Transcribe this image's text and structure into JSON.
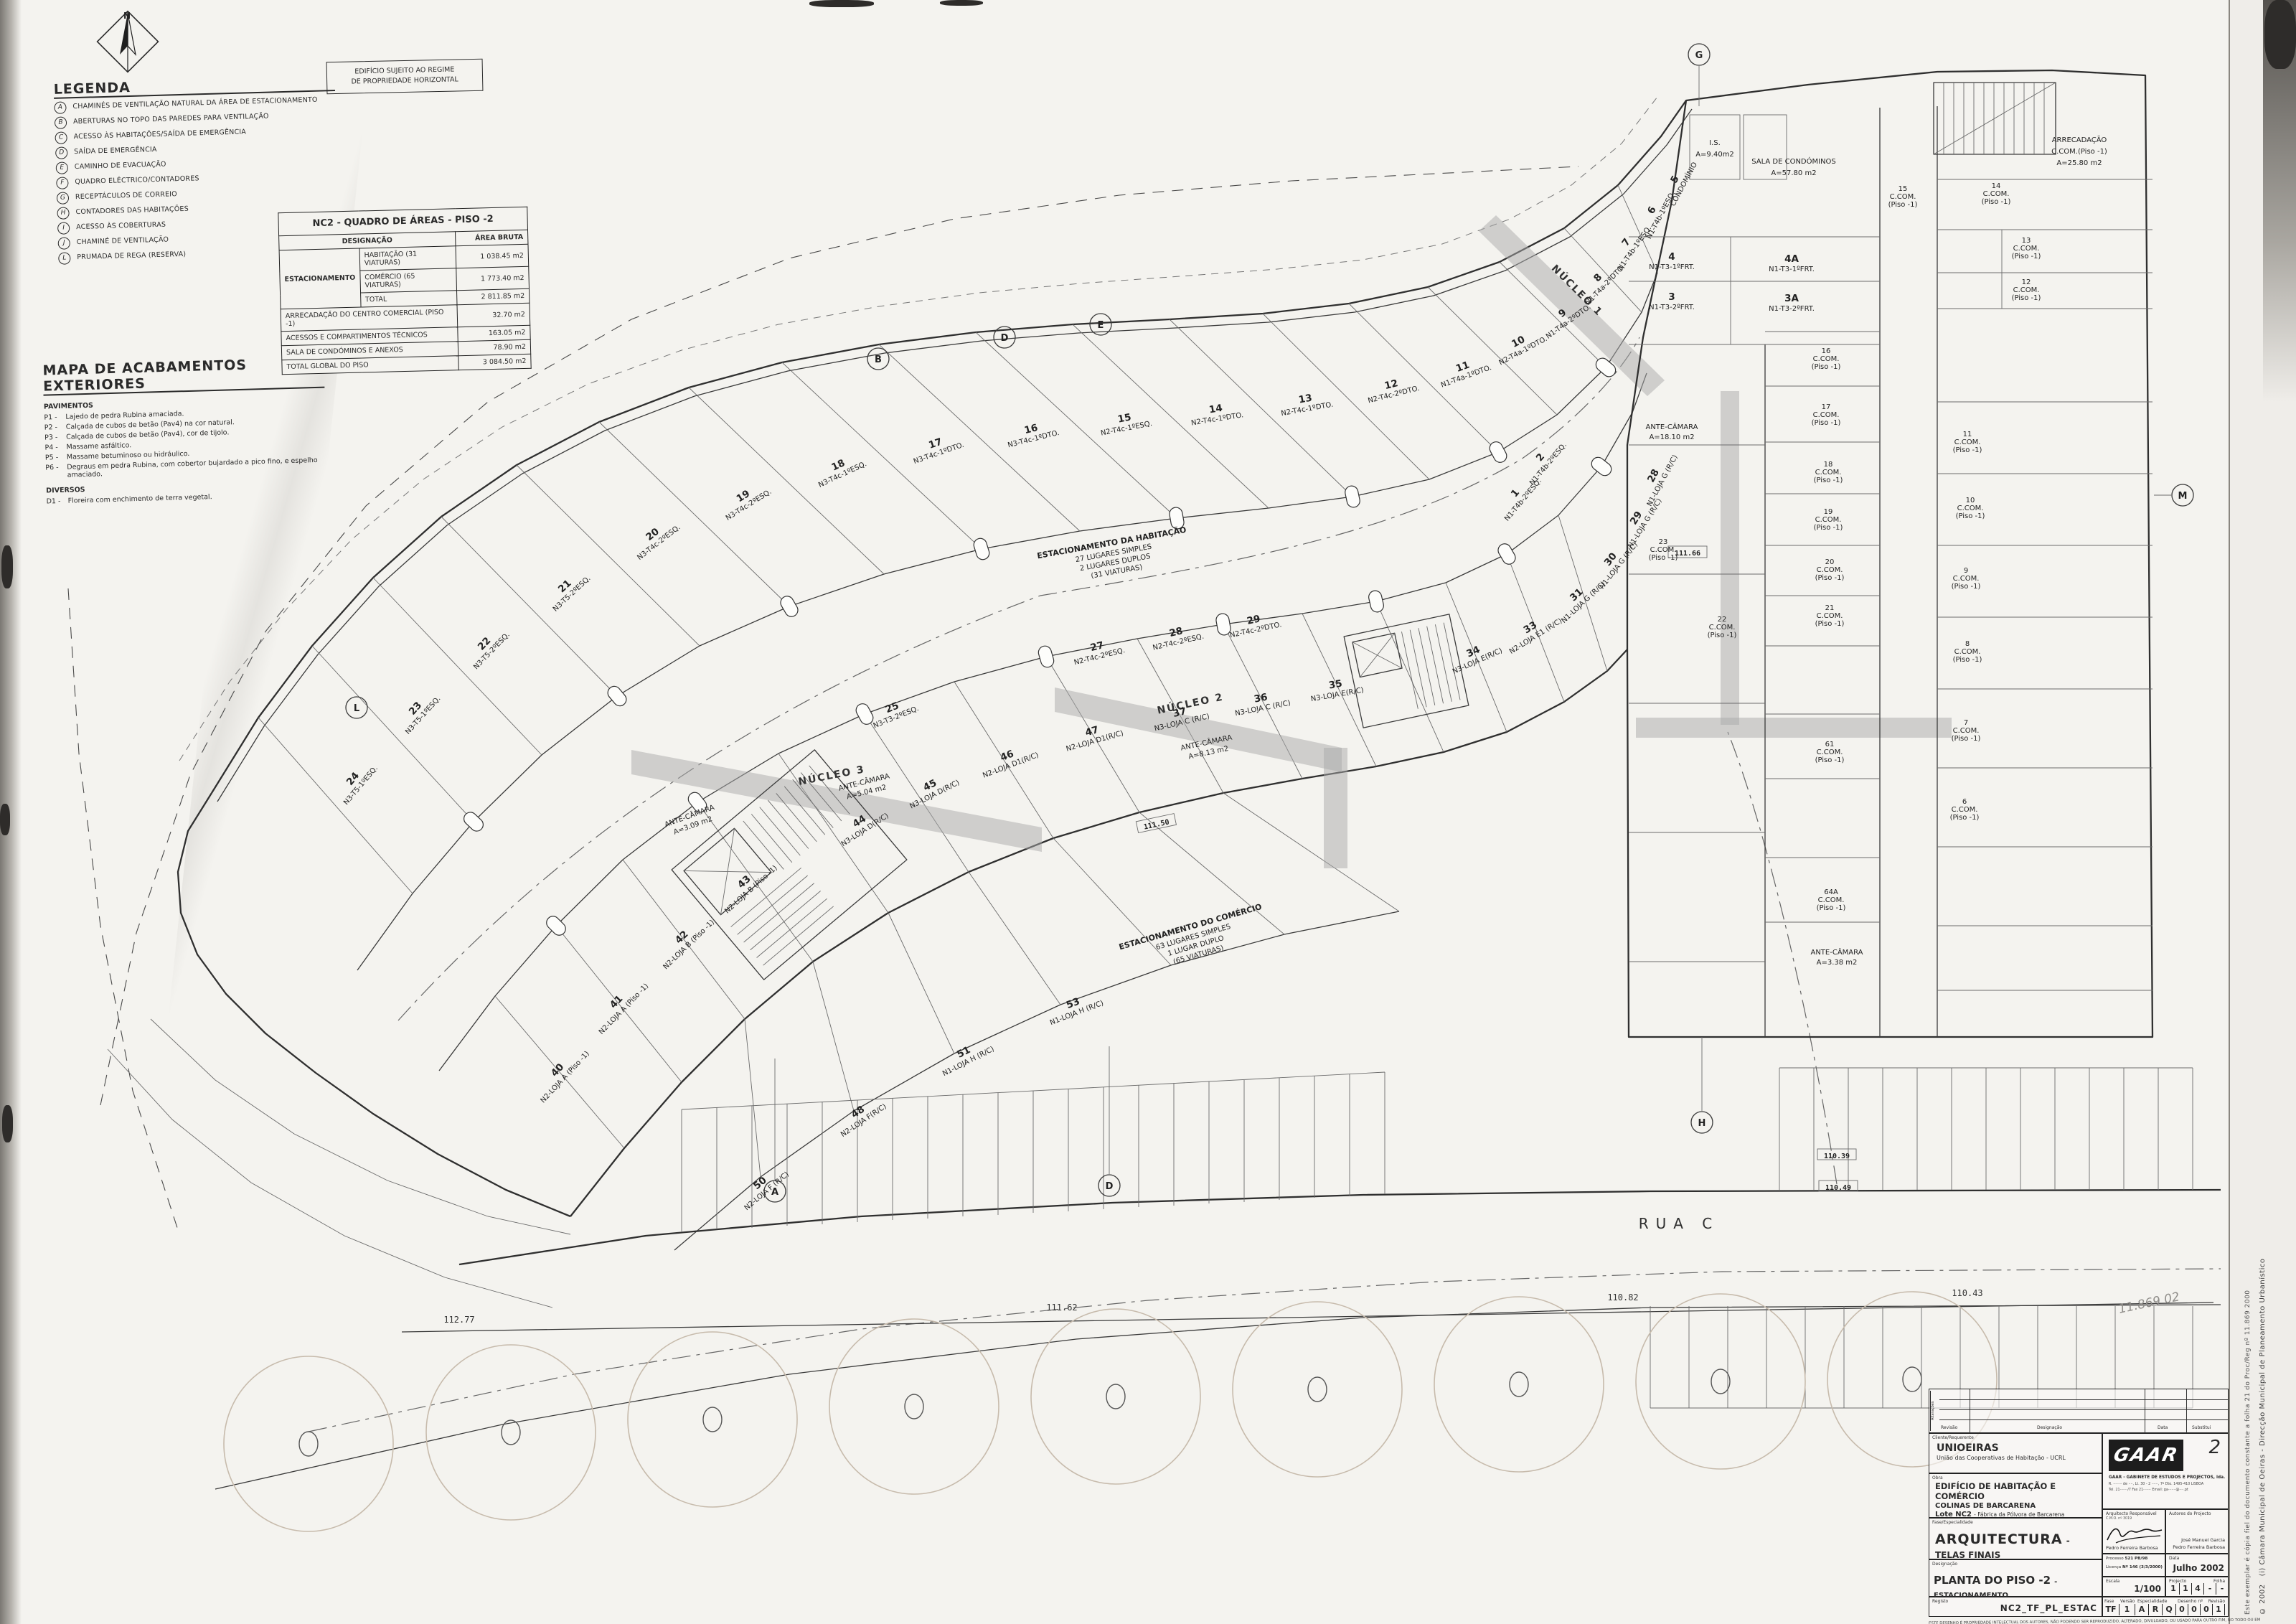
{
  "notice": {
    "line1": "EDIFÍCIO SUJEITO AO REGIME",
    "line2": "DE PROPRIEDADE HORIZONTAL"
  },
  "legend": {
    "title": "LEGENDA",
    "items": [
      {
        "k": "A",
        "t": "CHAMINÉS DE VENTILAÇÃO NATURAL DA ÁREA DE ESTACIONAMENTO"
      },
      {
        "k": "B",
        "t": "ABERTURAS NO TOPO DAS PAREDES PARA VENTILAÇÃO"
      },
      {
        "k": "C",
        "t": "ACESSO ÀS HABITAÇÕES/SAÍDA DE EMERGÊNCIA"
      },
      {
        "k": "D",
        "t": "SAÍDA DE EMERGÊNCIA"
      },
      {
        "k": "E",
        "t": "CAMINHO DE EVACUAÇÃO"
      },
      {
        "k": "F",
        "t": "QUADRO ELÉCTRICO/CONTADORES"
      },
      {
        "k": "G",
        "t": "RECEPTÁCULOS DE CORREIO"
      },
      {
        "k": "H",
        "t": "CONTADORES DAS HABITAÇÕES"
      },
      {
        "k": "I",
        "t": "ACESSO ÀS COBERTURAS"
      },
      {
        "k": "J",
        "t": "CHAMINÉ DE VENTILAÇÃO"
      },
      {
        "k": "L",
        "t": "PRUMADA DE REGA (RESERVA)"
      }
    ]
  },
  "finishes": {
    "title": "MAPA DE ACABAMENTOS EXTERIORES",
    "group1": "PAVIMENTOS",
    "items": [
      {
        "k": "P1 -",
        "t": "Lajedo de pedra Rubina amaciada."
      },
      {
        "k": "P2 -",
        "t": "Calçada de cubos de betão (Pav4) na cor natural."
      },
      {
        "k": "P3 -",
        "t": "Calçada de cubos de betão (Pav4), cor de tijolo."
      },
      {
        "k": "P4 -",
        "t": "Massame asfáltico."
      },
      {
        "k": "P5 -",
        "t": "Massame betuminoso ou hidráulico."
      },
      {
        "k": "P6 -",
        "t": "Degraus em pedra Rubina, com cobertor bujardado a pico fino, e espelho amaciado."
      }
    ],
    "group2": "DIVERSOS",
    "d1k": "D1 -",
    "d1t": "Floreira com enchimento de terra vegetal."
  },
  "areas_table": {
    "title": "NC2 - QUADRO DE ÁREAS - PISO -2",
    "col_designacao": "DESIGNAÇÃO",
    "col_area": "ÁREA BRUTA",
    "group_label": "ESTACIONAMENTO",
    "rows_group": [
      {
        "label": "HABITAÇÃO (31 VIATURAS)",
        "area": "1 038.45 m2"
      },
      {
        "label": "COMÉRCIO (65 VIATURAS)",
        "area": "1 773.40 m2"
      },
      {
        "label": "TOTAL",
        "area": "2 811.85 m2"
      }
    ],
    "rows_full": [
      {
        "label": "ARRECADAÇÃO DO CENTRO COMERCIAL (PISO -1)",
        "area": "32.70 m2"
      },
      {
        "label": "ACESSOS E COMPARTIMENTOS TÉCNICOS",
        "area": "163.05 m2"
      },
      {
        "label": "SALA DE CONDÓMINOS E ANEXOS",
        "area": "78.90 m2"
      },
      {
        "label": "TOTAL GLOBAL DO PISO",
        "area": "3 084.50 m2"
      }
    ]
  },
  "plan": {
    "rua": "RUA C",
    "nuc1": "NÚCLEO 1",
    "nuc2": "NÚCLEO 2",
    "nuc3": "NÚCLEO 3",
    "north": "N",
    "ccom": "C.COM.",
    "piso1": "(Piso -1)",
    "note_hab": {
      "l1": "ESTACIONAMENTO DA HABITAÇÃO",
      "l2": "27 LUGARES SIMPLES",
      "l3": "2 LUGARES DUPLOS",
      "l4": "(31 VIATURAS)"
    },
    "note_com": {
      "l1": "ESTACIONAMENTO DO COMÉRCIO",
      "l2": "63 LUGARES SIMPLES",
      "l3": "1 LUGAR DUPLO",
      "l4": "(65 VIATURAS)"
    },
    "rooms": {
      "sala1": "SALA DE CONDÓMINOS",
      "sala2": "A=57.80 m2",
      "is1": "I.S.",
      "is2": "A=9.40m2",
      "arrec1": "ARRECADAÇÃO",
      "arrec2": "C.COM.(Piso -1)",
      "arrec3": "A=25.80 m2",
      "ante": "ANTE-CÂMARA",
      "a1": "A=8.13 m2",
      "a2": "A=5.04 m2",
      "a3": "A=3.09 m2",
      "a4": "A=18.10 m2",
      "a5": "A=3.38 m2"
    },
    "grid": {
      "a": "A",
      "b": "B",
      "d": "D",
      "e": "E",
      "g": "G",
      "h": "H",
      "l": "L",
      "m": "M"
    },
    "levels": {
      "lv1": "111.50",
      "lv2": "111.66",
      "lv3": "110.39",
      "lv4": "110.49",
      "lv5": "112.77",
      "lv6": "111.62",
      "lv7": "110.82",
      "lv8": "110.43"
    },
    "stalls": [
      {
        "n": "24",
        "c": "N3-T5-1ºESQ."
      },
      {
        "n": "23",
        "c": "N3-T5-1ºESQ."
      },
      {
        "n": "22",
        "c": "N3-T5-2ºESQ."
      },
      {
        "n": "21",
        "c": "N3-T5-2ºESQ."
      },
      {
        "n": "20",
        "c": "N3-T4c-2ºESQ."
      },
      {
        "n": "19",
        "c": "N3-T4c-2ºESQ."
      },
      {
        "n": "18",
        "c": "N3-T4c-1ºESQ."
      },
      {
        "n": "17",
        "c": "N3-T4c-1ºDTO."
      },
      {
        "n": "16",
        "c": "N3-T4c-1ºDTO."
      },
      {
        "n": "15",
        "c": "N2-T4c-1ºESQ."
      },
      {
        "n": "14",
        "c": "N2-T4c-1ºDTO."
      },
      {
        "n": "13",
        "c": "N2-T4c-1ºDTO."
      },
      {
        "n": "12",
        "c": "N2-T4c-2ºDTO."
      },
      {
        "n": "11",
        "c": "N1-T4a-1ºDTO."
      },
      {
        "n": "10",
        "c": "N2-T4a-1ºDTO."
      },
      {
        "n": "9",
        "c": "N1-T4a-2ºDTO."
      },
      {
        "n": "8",
        "c": "N1-T4a-2ºDTO."
      },
      {
        "n": "7",
        "c": "N1-T4b-1ºESQ."
      },
      {
        "n": "6",
        "c": "N1-T4b-1ºESQ."
      },
      {
        "n": "5",
        "c": "CONDOMÍNIO"
      },
      {
        "n": "25",
        "c": "N3-T3-2ºESQ."
      },
      {
        "n": "27",
        "c": "N2-T4c-2ºESQ."
      },
      {
        "n": "28",
        "c": "N2-T4c-2ºESQ."
      },
      {
        "n": "29",
        "c": "N2-T4c-2ºDTO."
      },
      {
        "n": "2",
        "c": "N1-T4b-2ºESQ."
      },
      {
        "n": "1",
        "c": "N1-T4b-2ºESQ."
      },
      {
        "n": "4",
        "c": "N1-T3-1ºFRT."
      },
      {
        "n": "3",
        "c": "N1-T3-2ºFRT."
      },
      {
        "n": "4A",
        "c": "N1-T3-1ºFRT."
      },
      {
        "n": "3A",
        "c": "N1-T3-2ºFRT."
      },
      {
        "n": "40",
        "c": "N2-LOJA A (Piso -1)"
      },
      {
        "n": "41",
        "c": "N2-LOJA A (Piso -1)"
      },
      {
        "n": "42",
        "c": "N2-LOJA B (Piso -1)"
      },
      {
        "n": "43",
        "c": "N2-LOJA B (Piso -1)"
      },
      {
        "n": "44",
        "c": "N3-LOJA D(R/C)"
      },
      {
        "n": "45",
        "c": "N3-LOJA D(R/C)"
      },
      {
        "n": "46",
        "c": "N2-LOJA D1(R/C)"
      },
      {
        "n": "47",
        "c": "N2-LOJA D1(R/C)"
      },
      {
        "n": "37",
        "c": "N3-LOJA C (R/C)"
      },
      {
        "n": "36",
        "c": "N3-LOJA C (R/C)"
      },
      {
        "n": "35",
        "c": "N3-LOJA E(R/C)"
      },
      {
        "n": "34",
        "c": "N3-LOJA E(R/C)"
      },
      {
        "n": "33",
        "c": "N2-LOJA E1 (R/C)"
      },
      {
        "n": "31",
        "c": "N1-LOJA G (R/C)"
      },
      {
        "n": "30",
        "c": "N1-LOJA G (R/C)"
      },
      {
        "n": "29",
        "c": "N1-LOJA G (R/C)"
      },
      {
        "n": "28",
        "c": "N1-LOJA G (R/C)"
      },
      {
        "n": "50",
        "c": "N2-LOJA F (R/C)"
      },
      {
        "n": "48",
        "c": "N2-LOJA F(R/C)"
      },
      {
        "n": "51",
        "c": "N1-LOJA H (R/C)"
      },
      {
        "n": "53",
        "c": "N1-LOJA H (R/C)"
      }
    ],
    "wing": [
      "16",
      "17",
      "18",
      "19",
      "20",
      "21",
      "22",
      "23",
      "61",
      "64A",
      "15",
      "14",
      "13",
      "12",
      "11",
      "10",
      "9",
      "8",
      "7",
      "6"
    ]
  },
  "titleblock": {
    "labels": {
      "cliente": "Cliente/Requerente",
      "obra": "Obra",
      "fase": "Fase/Especialidade",
      "designacao": "Designação",
      "registo": "Registo",
      "arq": "Arquitecto Responsável",
      "autores": "Autores do Projecto",
      "processo": "Processo",
      "licenca": "Licença",
      "data": "Data",
      "escala": "Escala",
      "projecto": "Projecto",
      "folha": "Folha",
      "fase2": "Fase",
      "versao": "Versão",
      "especialidade": "Especialidade",
      "desenho": "Desenho nº",
      "revisao": "Revisão",
      "substitui": "Substitui",
      "designacao2": "Designação",
      "alteracoes": "Alterações"
    },
    "cliente1": "UNIOEIRAS",
    "cliente2": "União das Cooperativas de Habitação - UCRL",
    "obra1": "EDIFÍCIO DE HABITAÇÃO E COMÉRCIO",
    "obra2": "COLINAS DE BARCARENA",
    "obra3a": "Lote NC2",
    "obra3b": "- Fábrica da Pólvora de Barcarena",
    "fase_text": "ARQUITECTURA",
    "fase_text2": "- TELAS FINAIS",
    "des_text": "PLANTA DO PISO -2",
    "des_text2": "- ESTACIONAMENTO",
    "registo_text": "NC2_TF_PL_ESTAC",
    "sheet_num": "2",
    "firm1": "GAAR - GABINETE DE ESTUDOS E PROJECTOS, lda.",
    "firm2": "R. ········ de ····, Lt. 30 - 2 ······, 7º Dto.  1495-410 LISBOA",
    "firm3": "Tel. 21·······/7  Fax 21·······  Email: ga·······@····.pt",
    "arq_small": "C.M.O. nº 3019",
    "arq_name": "Pedro Ferreira Barbosa",
    "autor1": "José Manuel Garcia",
    "autor2": "Pedro Ferreira Barbosa",
    "processo_val": "521 PB/98",
    "licenca_val": "Nº 146 (3/3/2000)",
    "data_val": "Julho 2002",
    "escala_val": "1/100",
    "projecto_boxes": [
      "1",
      "1",
      "4",
      "-",
      "-"
    ],
    "fase_box": "TF",
    "versao_box": "1",
    "esp_boxes": [
      "A",
      "R",
      "Q"
    ],
    "des_boxes": [
      "0",
      "0",
      "0",
      "1"
    ],
    "disclaimer": "ESTE DESENHO É PROPRIEDADE INTELECTUAL DOS AUTORES, NÃO PODENDO SER REPRODUZIDO, ALTERADO, DIVULGADO, OU USADO PARA OUTRO FIM, NO TODO OU EM PARTE, SEM AUTORIZAÇÃO EXPRESSA DOS MESMOS.  RESERVADOS TODOS OS DIREITOS DE ACORDO COM A LEGISLAÇÃO EM VIGOR."
  },
  "margin": {
    "c1": "© 2002",
    "c2": "(i)  Câmara Municipal de Oeiras - Direcção Municipal de Planeamento Urbanístico",
    "c3": "Este exemplar é cópia fiel do documento constante a folha 21 do Proc/Reg nº 11.869 2000",
    "hand": "11.869 02"
  }
}
